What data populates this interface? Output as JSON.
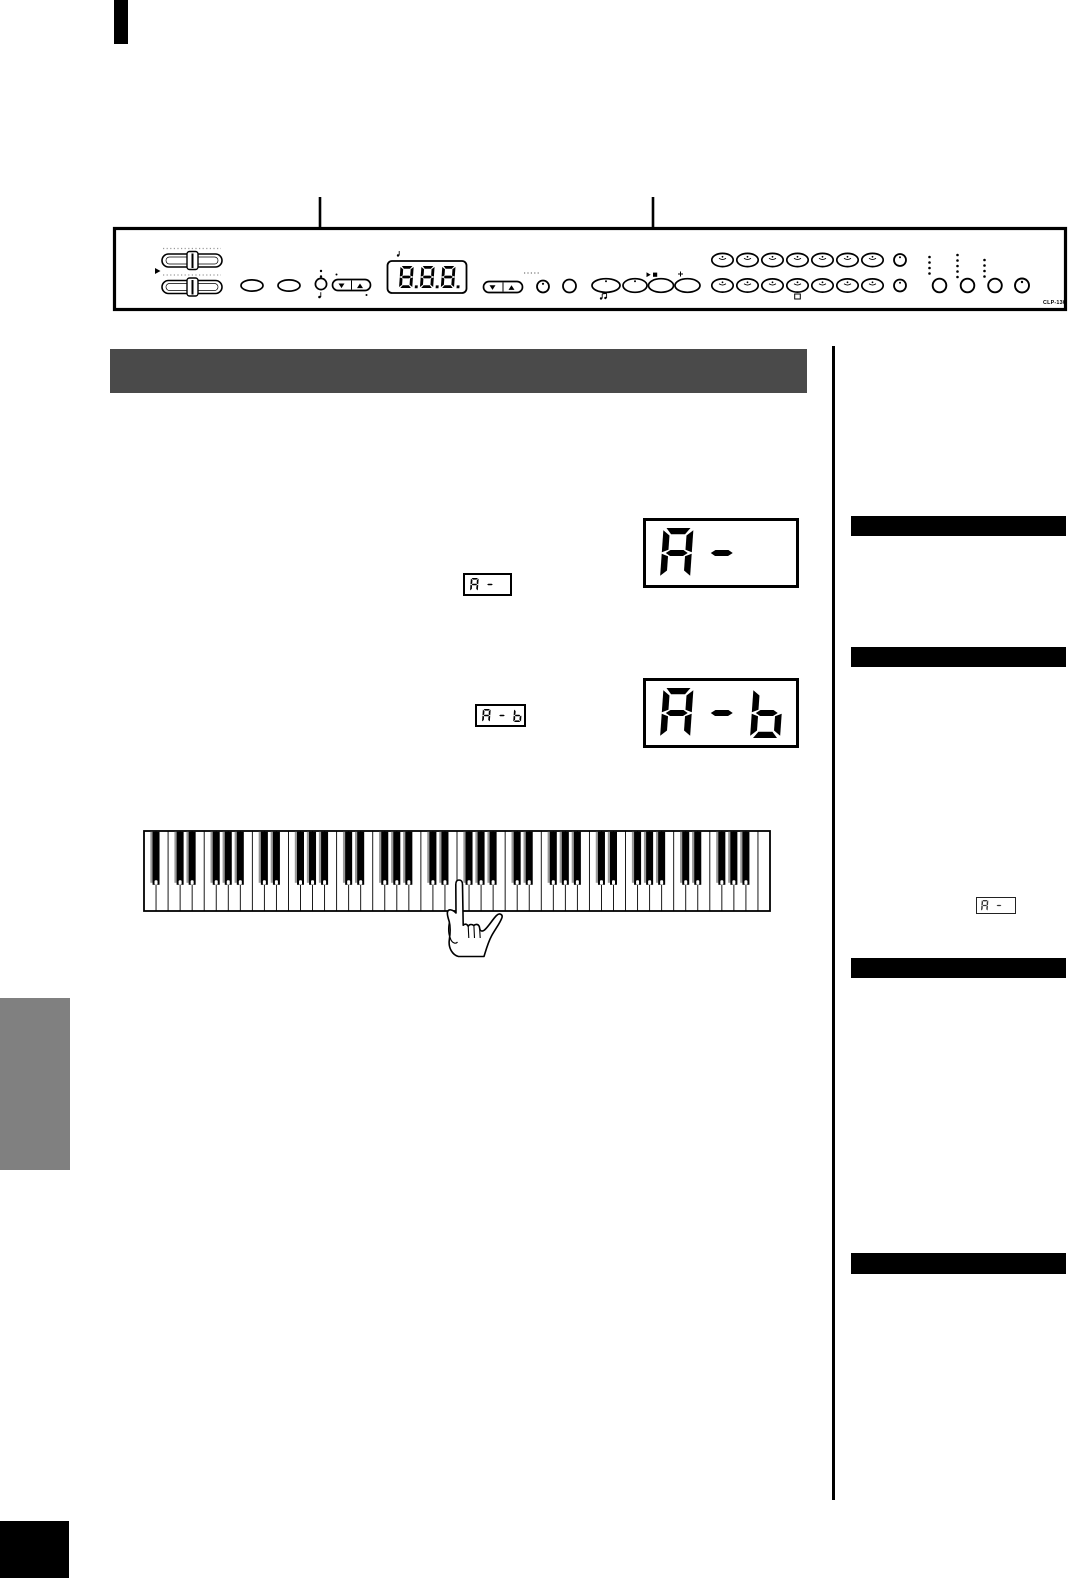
{
  "document": {
    "kind": "piano-owner-manual-page",
    "model": "CLP-130"
  },
  "panel_diagram": {
    "model_label": "CLP-130",
    "led_display_value": "8.8.8.",
    "callout_count": 2,
    "icons": [
      "volume-slider-icon",
      "metronome-note-icon",
      "song-notes-icon",
      "play-stop-icon",
      "pedal-icon"
    ]
  },
  "section_header": {
    "text": "",
    "color": "#4a4a4a"
  },
  "steps": {
    "step1_inline_display": "A-",
    "step1_large_display": "A-",
    "step2_inline_display": "A-b",
    "step2_large_display": "A-b"
  },
  "keyboard_diagram": {
    "total_keys": 88,
    "white_keys": 52,
    "start_letter": "A"
  },
  "sidebar": {
    "inline_display": "A-",
    "note_bar_color": "#000000",
    "note_bar_count": 4,
    "divider_color": "#000000"
  },
  "page_marks": {
    "top_marker_color": "#000000",
    "tab_color": "#808080",
    "footer_block_color": "#000000"
  }
}
